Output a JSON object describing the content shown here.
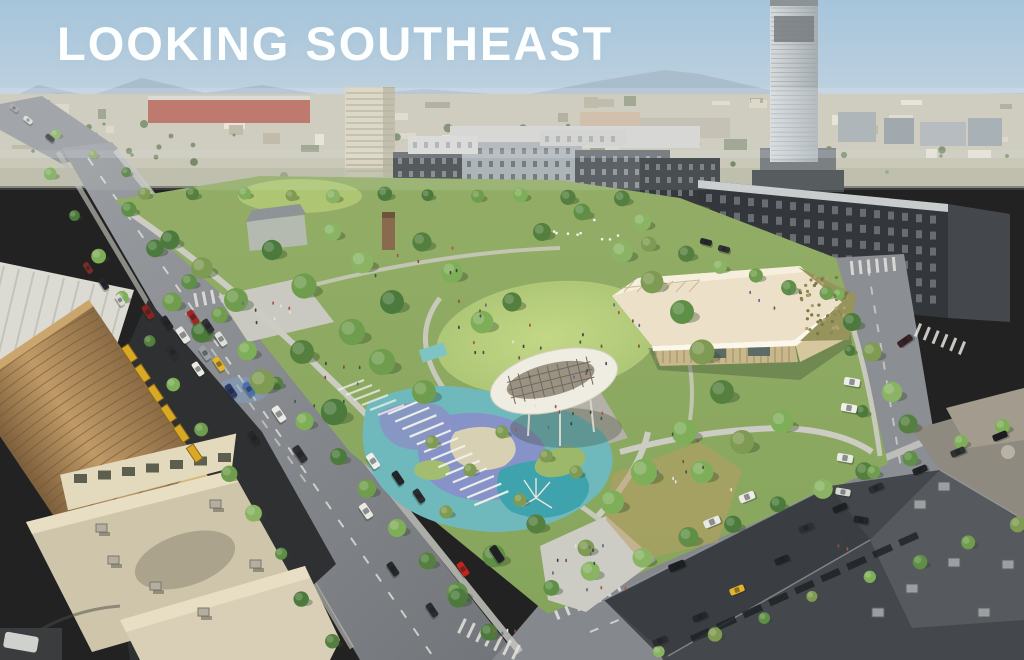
{
  "slide": {
    "title": "LOOKING SOUTHEAST"
  },
  "scene": {
    "type": "aerial-architectural-rendering",
    "description": "Aerial bird's-eye rendering looking southeast over a new urban park surrounded by streets, mid-rise apartment blocks, a downtown tower and industrial warehouses",
    "landmarks": {
      "park": "tree-filled park with central lawn",
      "pavilion": "community pavilion with cream roof and green roof section",
      "canopy": "leaf-shaped solar shade canopy over plaza",
      "playground": "blue and teal splash playground with palms and white trellis",
      "tower": "high-rise tower at right edge",
      "apartments": "grey mid-rise apartment complexes behind the park",
      "warehouse": "barrel-roof warehouse and flat tan rooftops at lower left",
      "rooftops": "dark industrial rooftops at lower right",
      "streets": "tree-lined streets with traffic and parked cars",
      "horizon": "hazy mountains, hillside neighborhoods and distant bay"
    },
    "palette": {
      "sky_top": "#a5c4db",
      "sky_horizon": "#d8e0e3",
      "mountain": "#a9bccb",
      "park_green": "#9cb66b",
      "lawn_light": "#bcd381",
      "canopy_white": "#efece1",
      "pavilion_roof": "#ece1c8",
      "pool_teal": "#58b2b8",
      "pool_periwinkle": "#8792c8",
      "asphalt": "#8d9094",
      "warehouse_tan": "#b08d5e",
      "taxi_yellow": "#e3b427",
      "car_red": "#c5231d"
    }
  }
}
